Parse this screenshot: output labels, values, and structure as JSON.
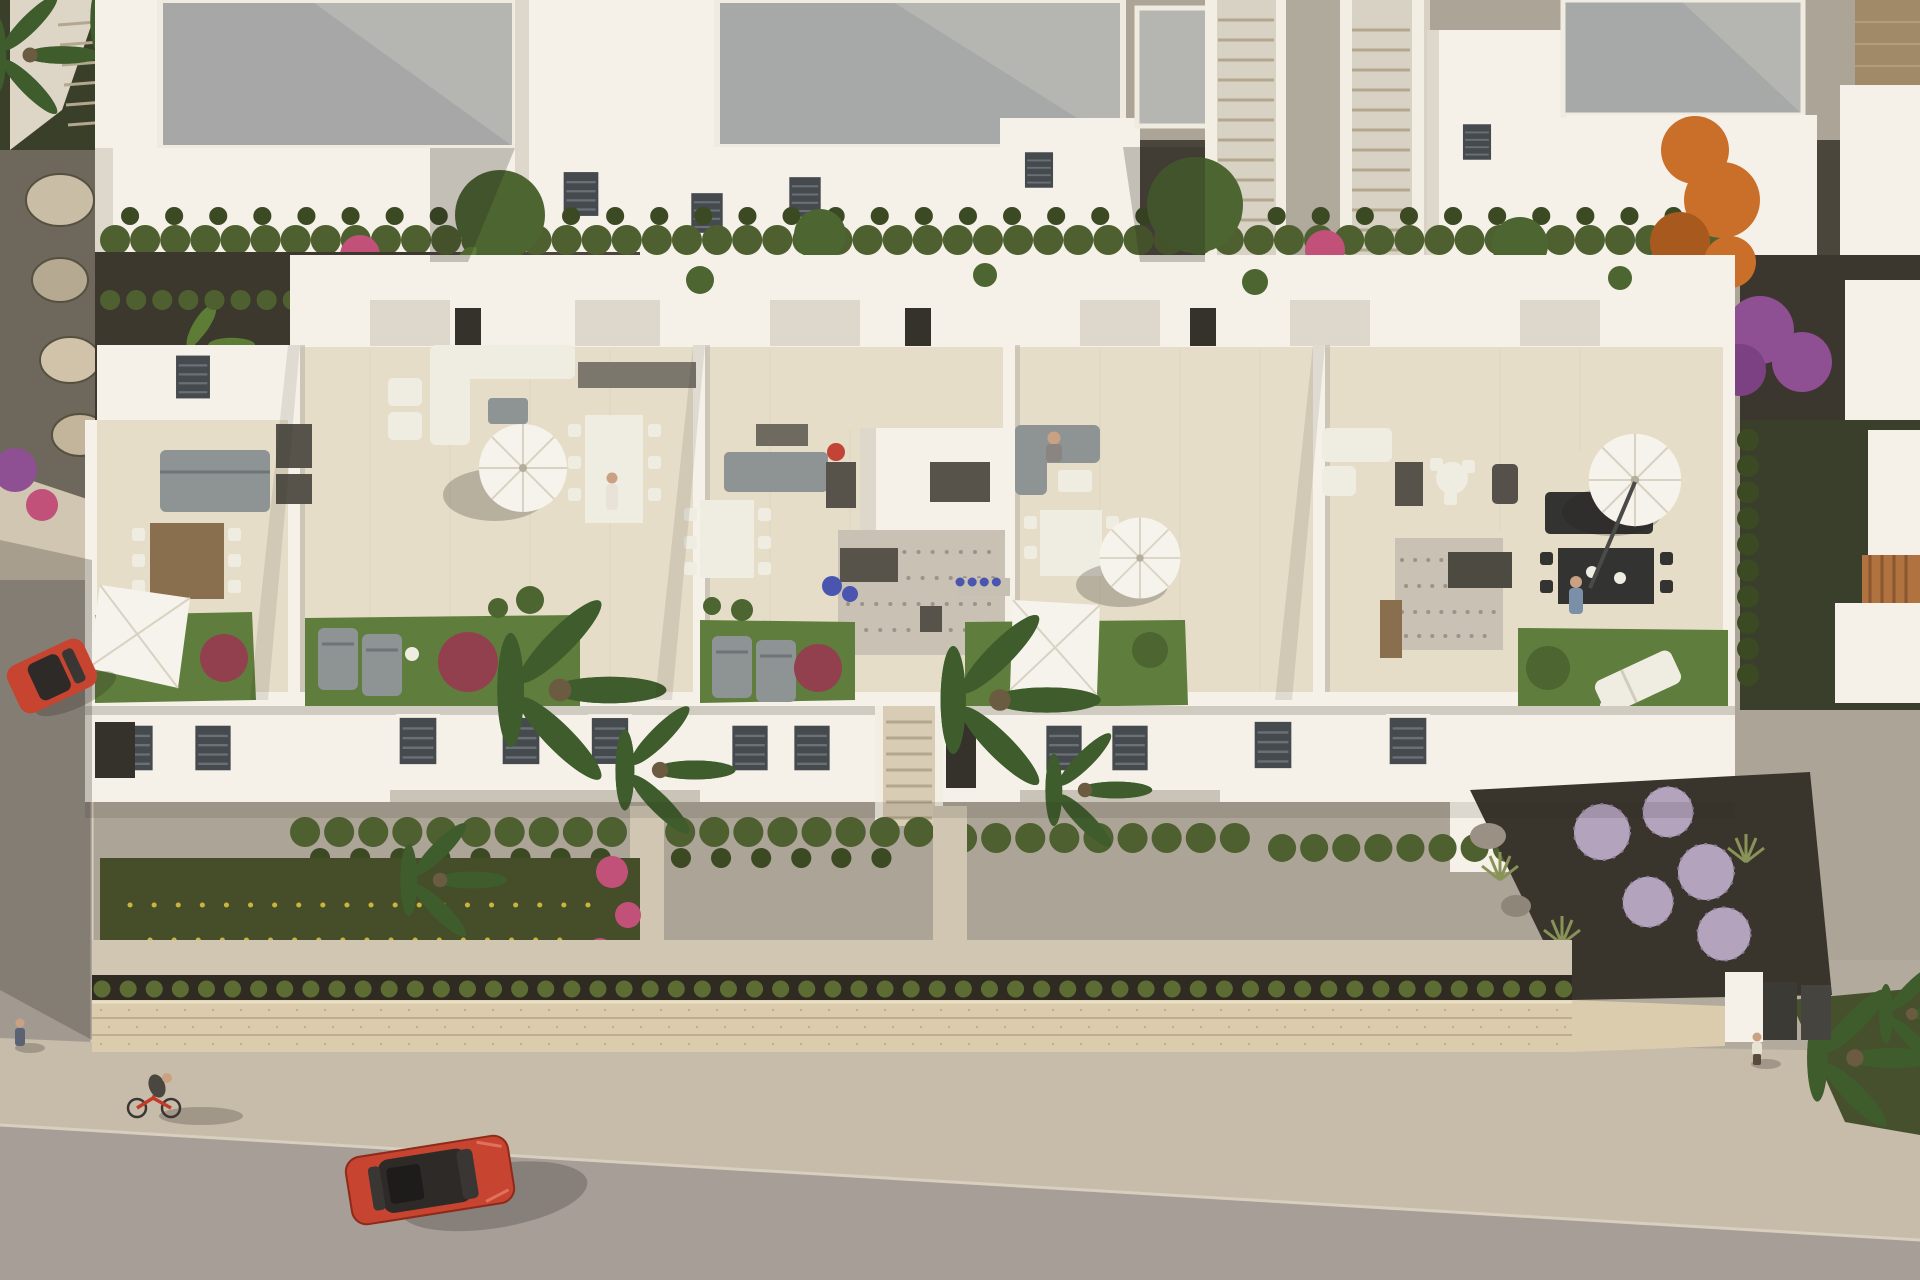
{
  "scene": {
    "description": "Aerial 3D architectural rendering of a modern white townhouse complex with rooftop terraces, gardens, a stone perimeter wall, sidewalk and street",
    "setting": "residential development, late-afternoon sunlight",
    "regions": {
      "top_row": "rear row of white flat-roofed houses separated by gravel alleys with hedges",
      "middle_block": "front row of townhouses seen from above with furnished roof terraces",
      "gardens": "front gardens with palms, hedges and lavender balls",
      "street": "sidewalk, stone retaining wall and asphalt street"
    },
    "objects": {
      "vehicles": [
        "red car driving on street",
        "red car parked on left street"
      ],
      "people": [
        "cyclist on red bicycle",
        "pedestrian on left sidewalk",
        "pedestrian on right sidewalk",
        "person on terrace",
        "person at terrace table"
      ],
      "terrace_items": [
        "gray corner sofas",
        "white dining tables",
        "dark wood dining table",
        "black dining table",
        "round white parasols",
        "square shade sails",
        "sun loungers",
        "lawn patches",
        "gravel patches",
        "planters with flowers"
      ]
    },
    "vegetation": [
      "palm trees",
      "banana plants",
      "cypress hedges",
      "orange autumn tree",
      "purple bougainvillea",
      "pink coral shrubs",
      "lavender balls",
      "red-leaf bushes"
    ]
  },
  "palette": {
    "base": "#b2aa9d",
    "upper": "#aca496",
    "street": "#a69e97",
    "streetLeft": "#a29a90",
    "sidewalk": "#c7bcaa",
    "apron": "#d0c6b2",
    "curb": "#d8cfbf",
    "stoneWall": "#daccad",
    "stoneLine": "#b5a483",
    "soil": "#2f2b23",
    "soilGarden": "#454d29",
    "hedge": "#4f6030",
    "hedgeDark": "#3c4a24",
    "tuft": "#5c6c33",
    "lawn": "#5f7d3c",
    "terrace": "#e6ddc8",
    "terraceShade": "#d2cab7",
    "white": "#f5f1e8",
    "whiteShade": "#ddd8cb",
    "whiteDeep": "#bcb7aa",
    "roof": "#b5b5b1",
    "roofShade": "#94979a",
    "gravel": "#c9c2b4",
    "gravelDot": "#9a948a",
    "boxDark": "#57534a",
    "furnGray": "#8e9394",
    "furnWhite": "#efece2",
    "wood": "#8a6f4e",
    "blackFurn": "#333332",
    "umbrella": "#f6f3ec",
    "umbSeam": "#d9d2c2",
    "treeGreen": "#4c6531",
    "palmGreen": "#3f5c2c",
    "banana": "#5d7c35",
    "orangeTree": "#c96f2a",
    "purpleFlower": "#8e4f93",
    "pinkFlower": "#c2517a",
    "redBush": "#93404e",
    "blueFlower": "#4a55b0",
    "lavender": "#b3a3bd",
    "carRed": "#c64430",
    "carGlass": "#2e2a27",
    "skin": "#caa183",
    "stepLine": "#b3a78e",
    "railWhite": "#f2eee4",
    "doorDark": "#35322c",
    "shadow": "rgba(38,35,30,0.24)",
    "tileLine": "#d6cdb8"
  }
}
